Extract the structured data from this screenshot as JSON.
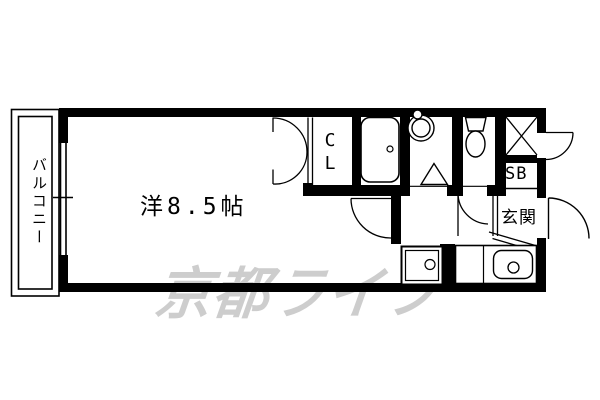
{
  "page": {
    "background_color": "#ffffff",
    "line_color": "#000000",
    "watermark_color": "#cdcdcd"
  },
  "floorplan": {
    "balcony_label": "バルコニー",
    "main_room_label": "洋8.5帖",
    "closet_label": "CL",
    "shoe_box_label": "SB",
    "entrance_label": "玄関",
    "watermark_text": "京都ライフ",
    "fixture_icons": [
      "bathtub-icon",
      "washbasin-icon",
      "toilet-icon",
      "shower-triangle-icon",
      "washing-machine-icon",
      "kitchen-sink-icon",
      "crossed-shaft-icon"
    ]
  }
}
